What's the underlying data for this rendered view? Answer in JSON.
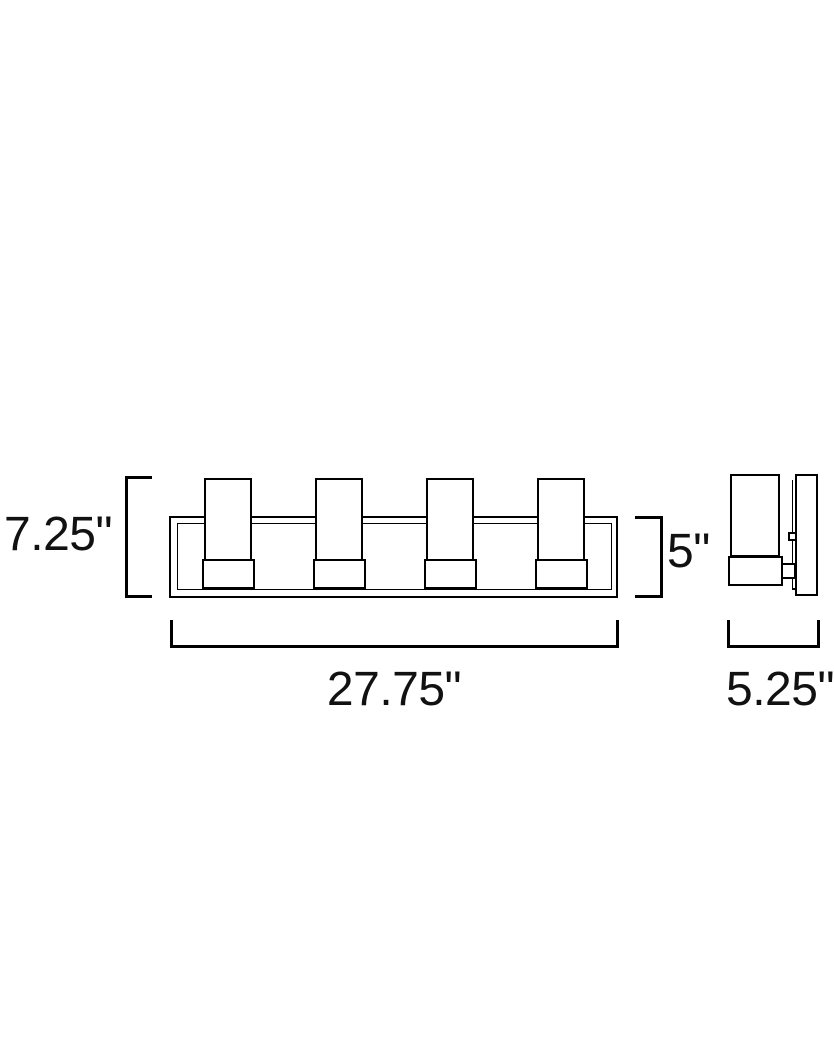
{
  "page": {
    "background_color": "#ffffff",
    "line_color": "#000000",
    "text_color": "#111111"
  },
  "diagram": {
    "views": {
      "front_view": "four-light bath vanity fixture, front elevation",
      "side_view": "fixture side profile with wall plate"
    },
    "dimension_labels": {
      "overall_height": "7.25\"",
      "body_height": "5\"",
      "overall_width": "27.75\"",
      "overall_depth": "5.25\""
    }
  }
}
